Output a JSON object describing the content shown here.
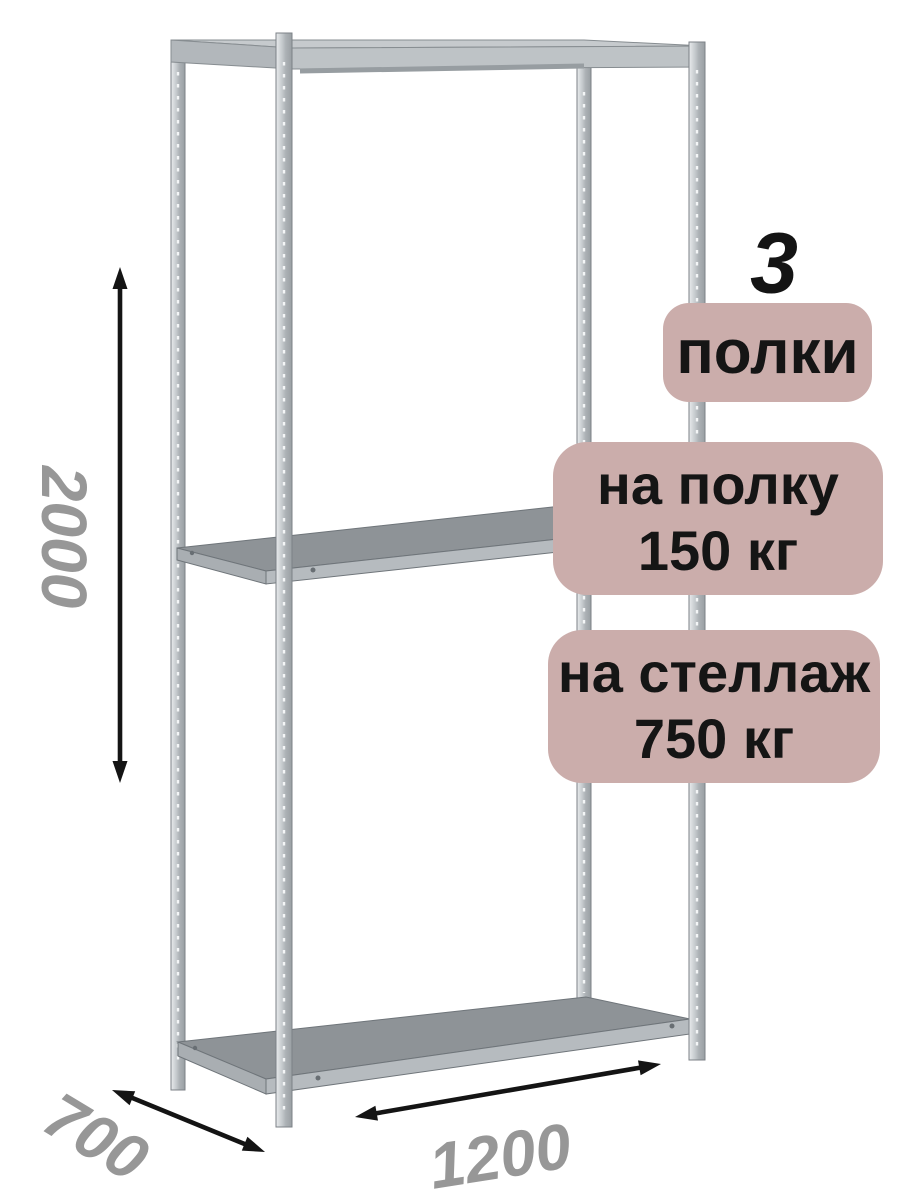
{
  "product": {
    "shelf_count": "3",
    "badges": [
      {
        "id": "shelf-count",
        "lines": [
          "полки"
        ]
      },
      {
        "id": "per-shelf-load",
        "lines": [
          "на полку",
          "150 кг"
        ]
      },
      {
        "id": "per-rack-load",
        "lines": [
          "на стеллаж",
          "750 кг"
        ]
      }
    ]
  },
  "dimensions": {
    "height": "2000",
    "depth": "700",
    "width": "1200"
  },
  "colors": {
    "background": "#ffffff",
    "badge_bg": "#cbadab",
    "badge_text": "#151515",
    "dimension_text": "#979797",
    "arrow": "#141414",
    "metal_light": "#dfe2e4",
    "metal_mid": "#b4b9bd",
    "metal_dark": "#8e9397",
    "metal_outline": "#6f757a"
  }
}
